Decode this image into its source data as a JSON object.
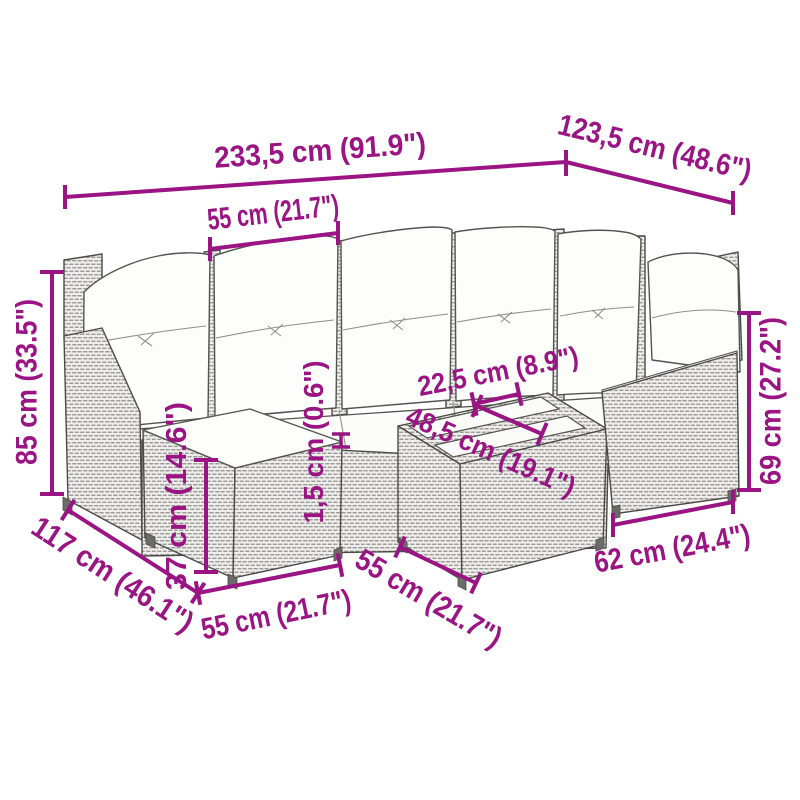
{
  "canvas": {
    "width": 800,
    "height": 800,
    "background": "#ffffff"
  },
  "colors": {
    "dimension_accent": "#9A1483",
    "line_art": "#4a4a48",
    "rattan_fill": "#efeeec",
    "cushion_fill": "#fdfdfb"
  },
  "illustration": {
    "name": "rattan-corner-sofa-set-line-drawing"
  },
  "dims": [
    {
      "id": "total-width",
      "text": "233,5 cm (91.9\")"
    },
    {
      "id": "total-depth",
      "text": "123,5 cm (48.6\")"
    },
    {
      "id": "seat-width-top",
      "text": "55 cm (21.7\")"
    },
    {
      "id": "total-height",
      "text": "85 cm (33.5\")"
    },
    {
      "id": "back-height",
      "text": "69 cm (27.2\")"
    },
    {
      "id": "tabletop-width",
      "text": "22,5 cm (8.9\")"
    },
    {
      "id": "tabletop-length",
      "text": "48,5 cm (19.1\")"
    },
    {
      "id": "cushion-thickness",
      "text": "1,5 cm (0.6\")"
    },
    {
      "id": "stool-height",
      "text": "37 cm (14.6\")"
    },
    {
      "id": "side-depth",
      "text": "117 cm (46.1\")"
    },
    {
      "id": "stool-width",
      "text": "55 cm (21.7\")"
    },
    {
      "id": "table-width",
      "text": "55 cm (21.7\")"
    },
    {
      "id": "armrest-width",
      "text": "62 cm (24.4\")"
    }
  ]
}
